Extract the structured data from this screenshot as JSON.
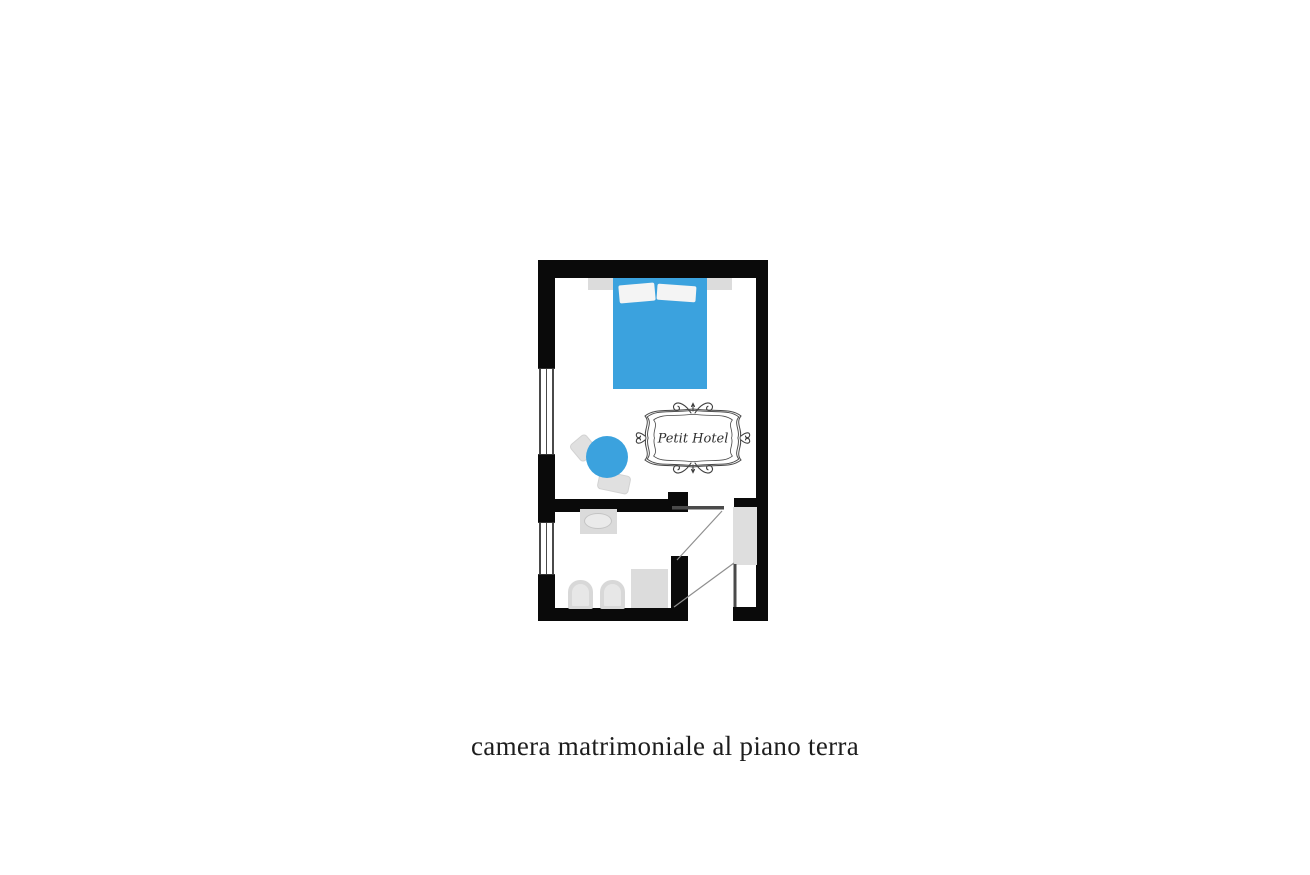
{
  "page": {
    "background_color": "#ffffff"
  },
  "caption": {
    "text": "camera matrimoniale al piano terra",
    "color": "#1d1d1d"
  },
  "floorplan": {
    "logo": {
      "text": "Petit Hotel"
    },
    "colors": {
      "wall": "#0a0a0a",
      "accent_blue": "#3ba2de",
      "fixture_gray": "#dcdcdc",
      "door_leaf": "#4a4a4a",
      "swing_line": "#8f8f8f"
    },
    "rooms": [
      {
        "name": "bedroom",
        "features": [
          "double-bed",
          "pillow",
          "pillow",
          "headboard",
          "round-table",
          "chair",
          "chair",
          "window",
          "petit-hotel-emblem"
        ]
      },
      {
        "name": "bathroom",
        "features": [
          "sink",
          "toilet",
          "bidet",
          "shower",
          "window",
          "door-swing"
        ]
      },
      {
        "name": "entry",
        "features": [
          "wardrobe",
          "entrance-door",
          "door-swing"
        ]
      }
    ]
  }
}
